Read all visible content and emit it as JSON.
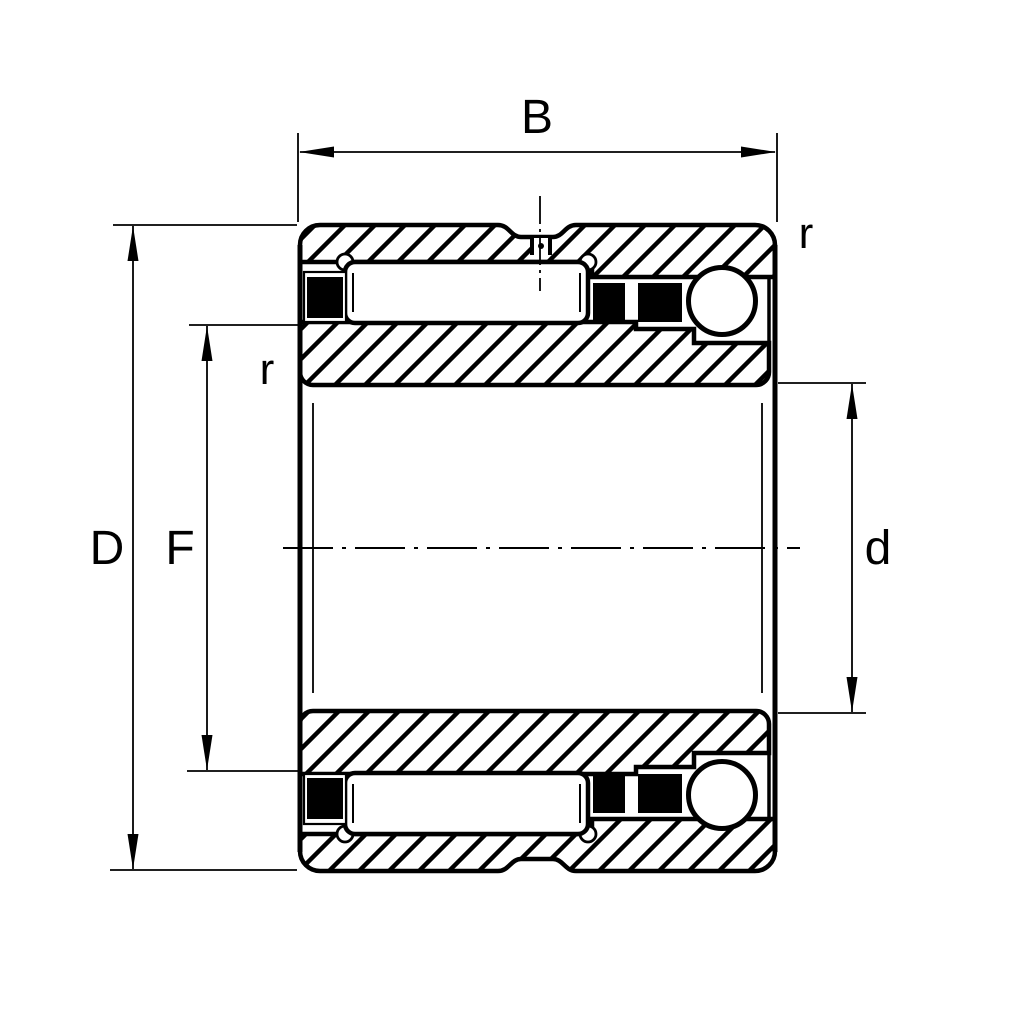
{
  "figure": {
    "kind": "technical-drawing",
    "subject": "Combined needle roller / angular contact ball bearing cross-section",
    "background_color": "#ffffff",
    "line_color": "#000000"
  },
  "labels": {
    "width": "B",
    "outside_diameter": "D",
    "raceway_diameter": "F",
    "bore_diameter": "d",
    "chamfer_inner": "r",
    "chamfer_outer": "r"
  }
}
